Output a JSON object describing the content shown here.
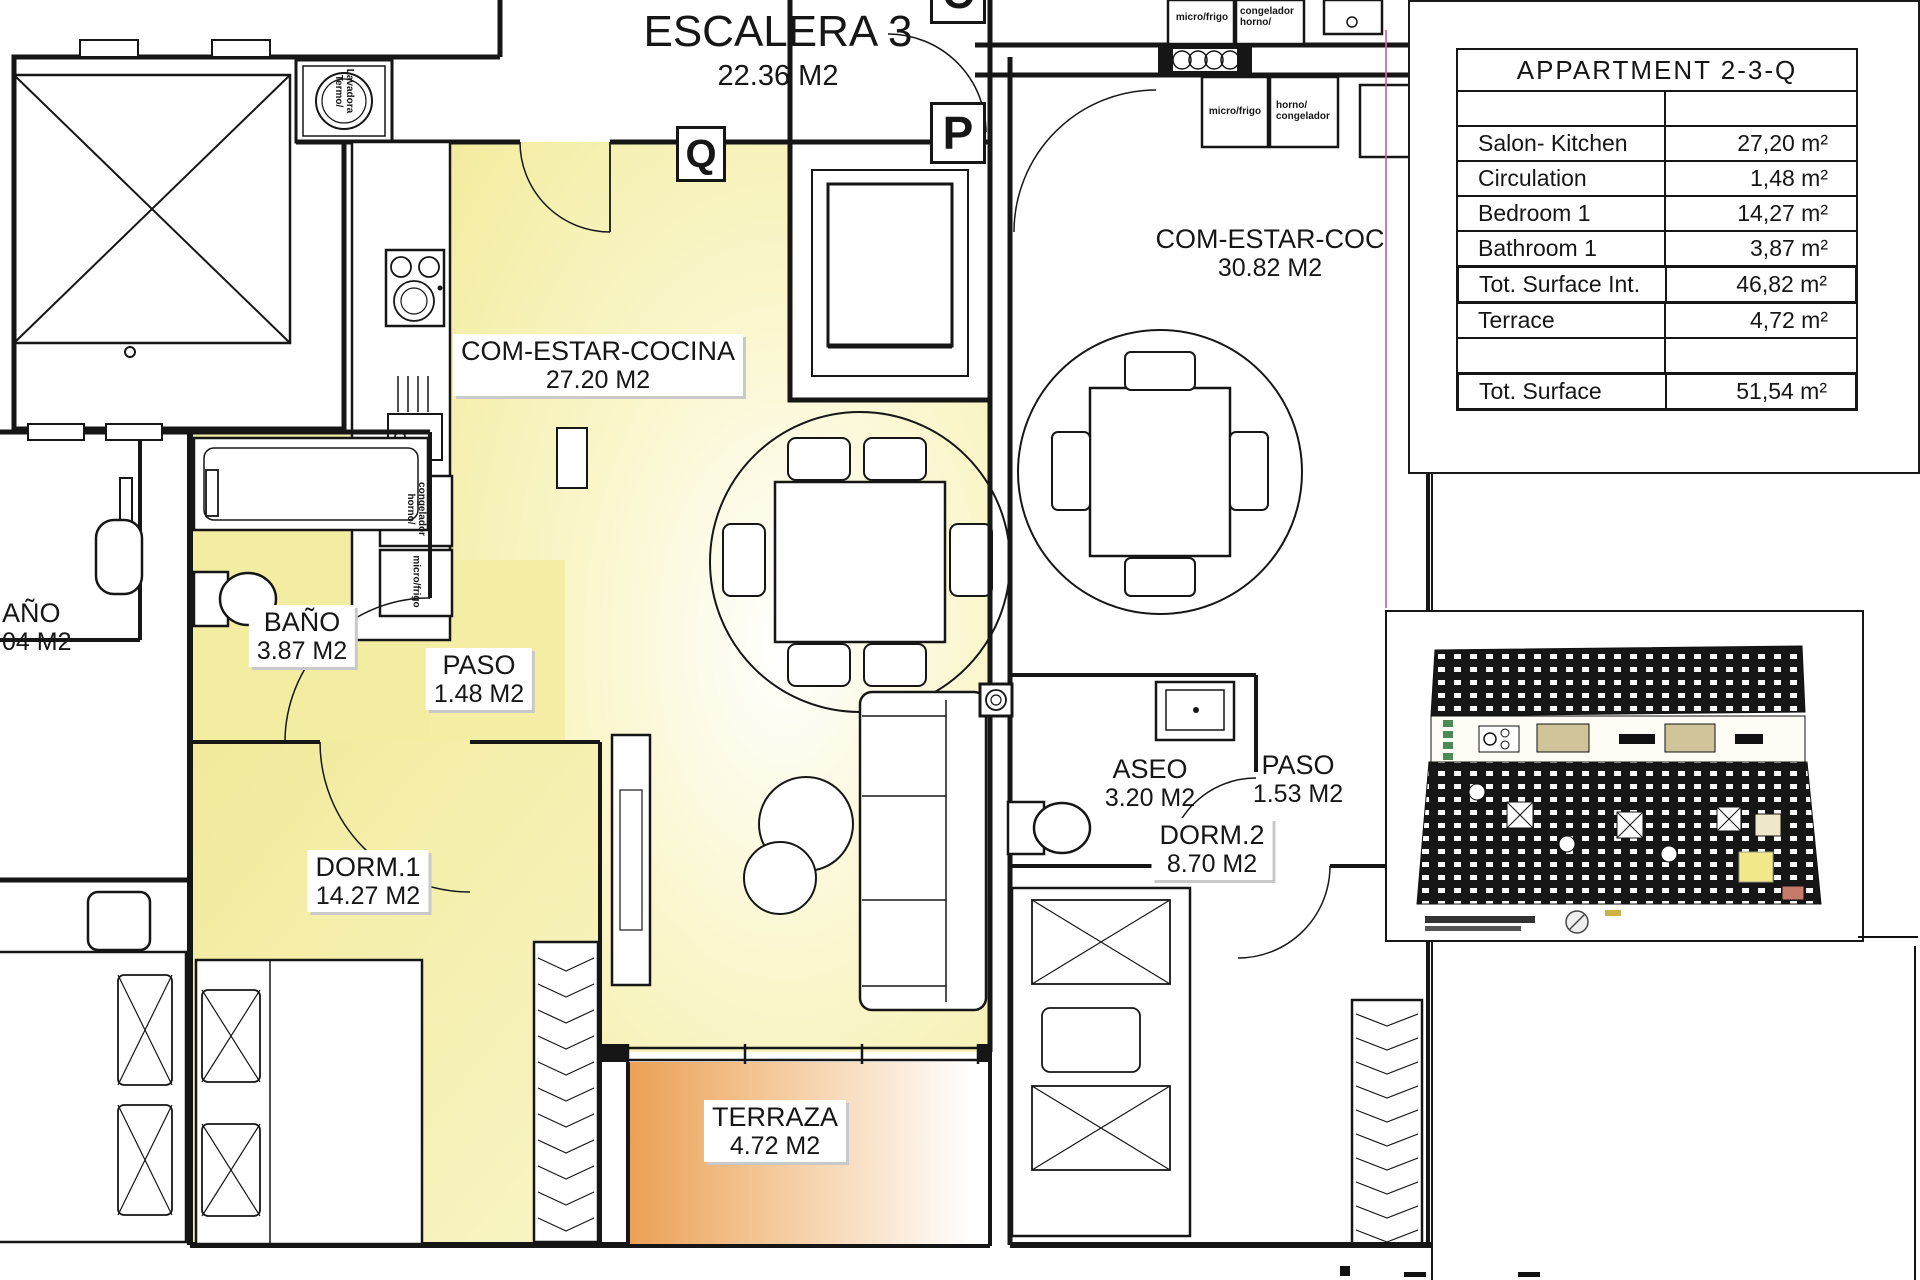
{
  "stairwell": {
    "name": "ESCALERA 3",
    "area": "22.36 M2"
  },
  "unit_markers": {
    "q": "Q",
    "p": "P",
    "c": "C"
  },
  "rooms": {
    "com_estar_cocina": {
      "name": "COM-ESTAR-COCINA",
      "area": "27.20 M2"
    },
    "bano": {
      "name": "BAÑO",
      "area": "3.87 M2"
    },
    "paso": {
      "name": "PASO",
      "area": "1.48 M2"
    },
    "dorm1": {
      "name": "DORM.1",
      "area": "14.27 M2"
    },
    "terraza": {
      "name": "TERRAZA",
      "area": "4.72 M2"
    },
    "com_estar_coc_neighbor": {
      "name": "COM-ESTAR-COC",
      "area": "30.82 M2"
    },
    "aseo": {
      "name": "ASEO",
      "area": "3.20 M2"
    },
    "paso_neighbor": {
      "name": "PASO",
      "area": "1.53 M2"
    },
    "dorm2": {
      "name": "DORM.2",
      "area": "8.70 M2"
    },
    "bano_left_cut": {
      "name": "AÑO",
      "area": "04 M2"
    }
  },
  "appliances": {
    "washer": "Lavadora\nTermo/",
    "freezer_oven": "congelador\nhorno/",
    "fridge_micro": "micro/frigo",
    "oven_freezer": "horno/\ncongelador"
  },
  "legend": {
    "title": "APPARTMENT 2-3-Q",
    "rows": [
      {
        "label": "",
        "value": ""
      },
      {
        "label": "Salon- Kitchen",
        "value": "27,20 m²"
      },
      {
        "label": "Circulation",
        "value": "1,48 m²"
      },
      {
        "label": "Bedroom 1",
        "value": "14,27 m²"
      },
      {
        "label": "Bathroom 1",
        "value": "3,87 m²"
      },
      {
        "label": "Tot. Surface Int.",
        "value": "46,82 m²"
      },
      {
        "label": "Terrace",
        "value": "4,72 m²"
      },
      {
        "label": "",
        "value": ""
      },
      {
        "label": "Tot. Surface",
        "value": "51,54 m²"
      }
    ]
  },
  "colors": {
    "room_fill_yellow": "#f3eda2",
    "terrace_fill_orange": "#eb9f54",
    "boundary_pink": "#cc6699",
    "wall_black": "#161616"
  }
}
